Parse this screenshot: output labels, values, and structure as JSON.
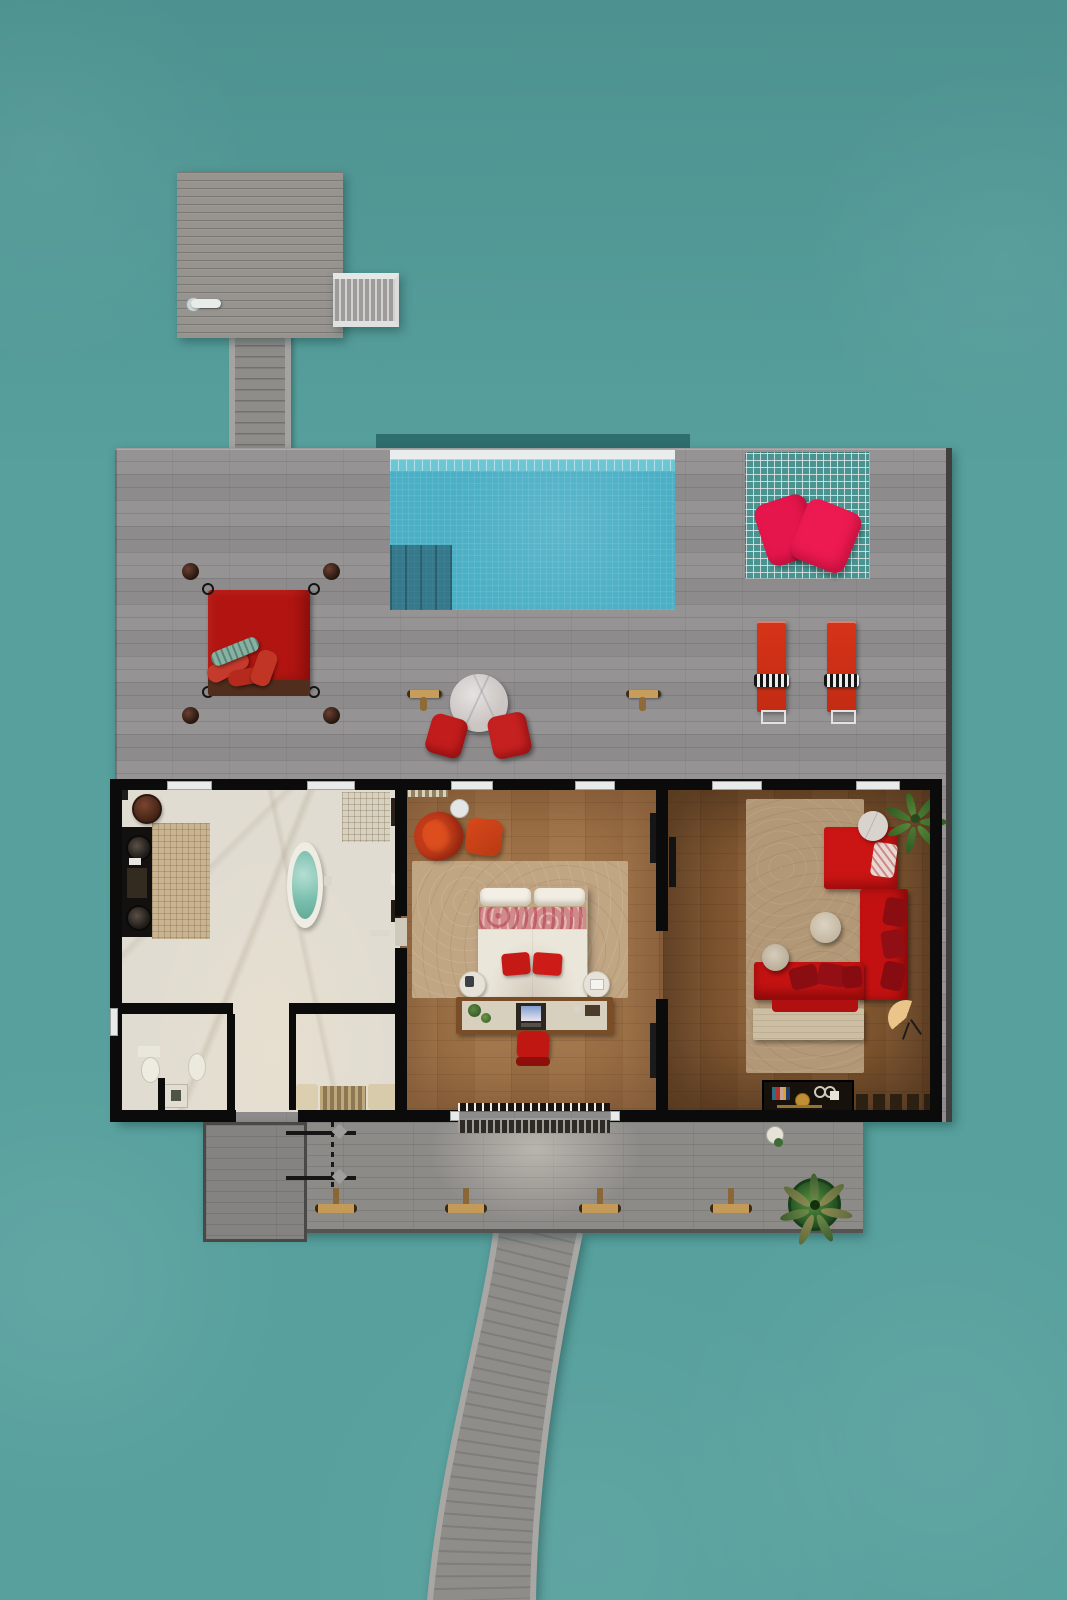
{
  "scene": {
    "type": "top-down architectural render",
    "setting": "overwater resort villa with pool deck, jetty and arrival platform",
    "palette": {
      "ocean": "#57a09d",
      "deck_wood": "#929090",
      "pool_water": "#4bafc5",
      "accent_red": "#c41a17",
      "accent_crimson": "#e5164c",
      "villa_wall": "#0b0b0b",
      "marble_floor": "#e1dcd1",
      "bedroom_wood": "#a3764a",
      "living_wood": "#8a5e35",
      "torch_gold": "#c49a58"
    },
    "areas": {
      "arrival_platform": {
        "items": [
          "wood-platform",
          "dock-cleat",
          "boarding-stairs",
          "connecting-walkway"
        ]
      },
      "main_deck": {
        "items": [
          {
            "name": "infinity-pool",
            "features": [
              "white-edge",
              "tile-band",
              "mosaic-water",
              "entry-steps"
            ]
          },
          {
            "name": "overwater-sun-net",
            "pillows": 2,
            "pillow_color": "#e5164c"
          },
          {
            "name": "four-poster-daybed",
            "mattress_color": "#b21511",
            "posts": 4,
            "pillows": 4
          },
          {
            "name": "sun-loungers",
            "count": 2,
            "color": "#d63418",
            "towel": "black-white-stripe"
          },
          {
            "name": "round-marble-table",
            "poufs": 2,
            "pouf_color": "#c21d1c"
          },
          {
            "name": "deck-torches",
            "count": 2
          }
        ]
      },
      "villa": {
        "bathroom": {
          "floor": "white marble",
          "items": [
            "double-sink-vanity",
            "mosaic-rug",
            "round-stool",
            "oval-bathtub",
            "rain-shower-area",
            "toilet",
            "bidet",
            "wc-sink",
            "closet-bench"
          ]
        },
        "bedroom": {
          "floor": "light wood",
          "items": [
            "king-bed",
            "floral-runner",
            "red-foot-pillows",
            "round-nightstands",
            "writing-desk",
            "laptop",
            "desk-chair",
            "lounge-armchair",
            "ottoman",
            "side-table",
            "area-rug",
            "wall-tv"
          ]
        },
        "living_room": {
          "floor": "dark wood",
          "items": [
            "l-shaped-red-sectional",
            "dark-red-pillows",
            "round-side-tables",
            "travertine-coffee-table",
            "stone-bench",
            "potted-palm",
            "hand-fan",
            "minibar-console",
            "stool-row",
            "wall-tv"
          ]
        }
      },
      "rear_deck": {
        "items": [
          "framed-deck-section",
          "outdoor-shower",
          "deck-torches-x4",
          "potted-palm",
          "entry-doormat",
          "entry-light-glow"
        ]
      },
      "jetty": {
        "shape": "curved walkway leading away from villa"
      }
    }
  }
}
